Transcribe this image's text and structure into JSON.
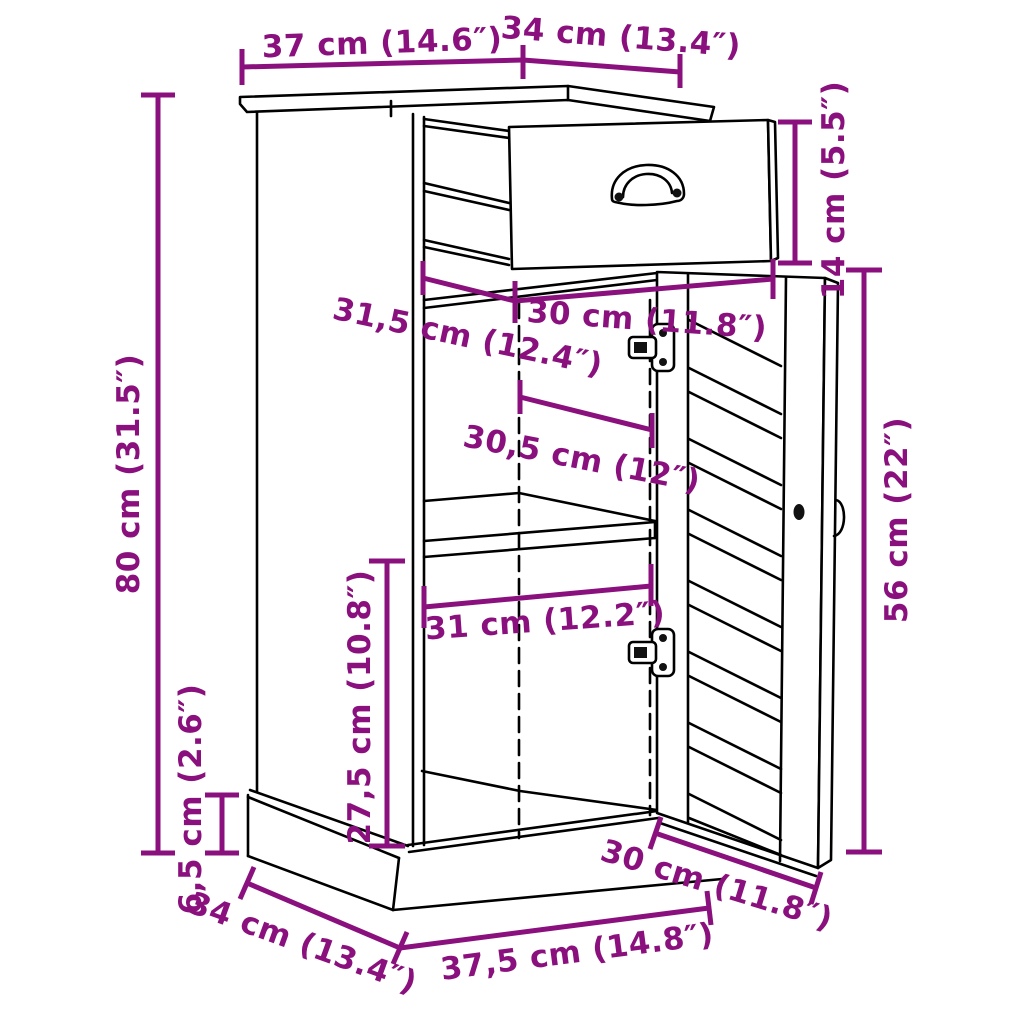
{
  "diagram": {
    "title": "cabinet-dimension-diagram",
    "product": "side cabinet with open drawer and louvered door",
    "background_color": "#ffffff",
    "line_color": "#000000",
    "dimension_color": "#8A107E",
    "dimensions": [
      {
        "id": "top-width",
        "label": "37 cm (14.6″)"
      },
      {
        "id": "top-depth",
        "label": "34 cm (13.4″)"
      },
      {
        "id": "overall-height",
        "label": "80 cm (31.5″)"
      },
      {
        "id": "drawer-height",
        "label": "14 cm (5.5″)"
      },
      {
        "id": "drawer-width",
        "label": "30 cm (11.8″)"
      },
      {
        "id": "interior-top-depth",
        "label": "31,5 cm (12.4″)"
      },
      {
        "id": "door-opening-width",
        "label": "30,5 cm (12″)"
      },
      {
        "id": "interior-width",
        "label": "31 cm (12.2″)"
      },
      {
        "id": "interior-height",
        "label": "27,5 cm (10.8″)"
      },
      {
        "id": "door-height",
        "label": "56 cm (22″)"
      },
      {
        "id": "plinth-height",
        "label": "6,5 cm (2.6″)"
      },
      {
        "id": "base-depth",
        "label": "34 cm (13.4″)"
      },
      {
        "id": "base-width",
        "label": "37,5 cm (14.8″)"
      },
      {
        "id": "base-door-width",
        "label": "30 cm (11.8″)"
      }
    ]
  }
}
